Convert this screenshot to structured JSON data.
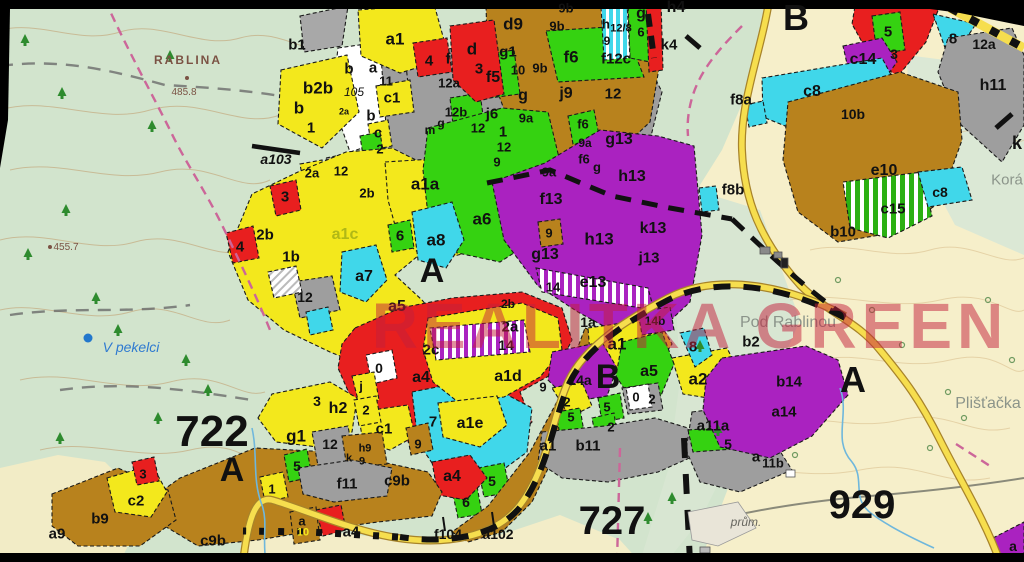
{
  "map": {
    "watermark": {
      "text": "REALITKA GREEN"
    },
    "region_numbers": [
      "722",
      "727",
      "929"
    ],
    "section_letters": [
      "A",
      "B"
    ],
    "place_names": [
      "RABLINA",
      "V pekelci",
      "Pod Rablinou",
      "Plišťačka",
      "Korá",
      "prům."
    ],
    "elevations": [
      "485.8",
      "455.7"
    ],
    "road_point_labels": [
      "a103",
      "f104",
      "a102"
    ],
    "palette": {
      "topo_green": "#d2e4cd",
      "cream": "#f6efca",
      "parcel_yellow": "#f3e81c",
      "parcel_green": "#35d211",
      "parcel_cyan": "#40d7ea",
      "parcel_purple": "#aa22c0",
      "parcel_red": "#e81f1f",
      "parcel_brown": "#b8821d",
      "parcel_gray": "#9e9e9e",
      "road_yellow": "#f6de4e",
      "watermark_red": "#c41f3c",
      "water_blue": "#2f7ad0"
    },
    "labels": [
      {
        "t": "b1",
        "x": 297,
        "y": 45
      },
      {
        "t": "b2b",
        "x": 318,
        "y": 88,
        "s": 17
      },
      {
        "t": "b",
        "x": 299,
        "y": 108,
        "s": 17
      },
      {
        "t": "1",
        "x": 311,
        "y": 128
      },
      {
        "t": "b",
        "x": 349,
        "y": 69
      },
      {
        "t": "105",
        "x": 354,
        "y": 92,
        "s": 12,
        "b": false,
        "it": true
      },
      {
        "t": "a",
        "x": 373,
        "y": 68
      },
      {
        "t": "11",
        "x": 386,
        "y": 81,
        "s": 13
      },
      {
        "t": "c1",
        "x": 392,
        "y": 98
      },
      {
        "t": "b",
        "x": 371,
        "y": 116
      },
      {
        "t": "c",
        "x": 378,
        "y": 133
      },
      {
        "t": "2",
        "x": 380,
        "y": 149,
        "s": 13
      },
      {
        "t": "2a",
        "x": 344,
        "y": 112,
        "s": 9
      },
      {
        "t": "a103",
        "x": 276,
        "y": 159,
        "s": 14,
        "it": true
      },
      {
        "t": "2a",
        "x": 312,
        "y": 173,
        "s": 13
      },
      {
        "t": "12",
        "x": 341,
        "y": 171,
        "s": 13
      },
      {
        "t": "a1",
        "x": 395,
        "y": 39,
        "s": 17
      },
      {
        "t": "4",
        "x": 429,
        "y": 61
      },
      {
        "t": "f",
        "x": 448,
        "y": 59
      },
      {
        "t": "d",
        "x": 472,
        "y": 49,
        "s": 17
      },
      {
        "t": "3",
        "x": 479,
        "y": 69
      },
      {
        "t": "12a",
        "x": 449,
        "y": 83,
        "s": 13
      },
      {
        "t": "d9",
        "x": 513,
        "y": 24,
        "s": 17
      },
      {
        "t": "9b",
        "x": 566,
        "y": 8,
        "s": 13
      },
      {
        "t": "9b",
        "x": 557,
        "y": 26,
        "s": 13
      },
      {
        "t": "9b",
        "x": 540,
        "y": 68,
        "s": 13
      },
      {
        "t": "g1",
        "x": 508,
        "y": 52
      },
      {
        "t": "10",
        "x": 518,
        "y": 70,
        "s": 13
      },
      {
        "t": "f5",
        "x": 493,
        "y": 78,
        "s": 16
      },
      {
        "t": "f6",
        "x": 571,
        "y": 57,
        "s": 17
      },
      {
        "t": "g",
        "x": 523,
        "y": 96,
        "s": 16
      },
      {
        "t": "j9",
        "x": 566,
        "y": 94,
        "s": 16
      },
      {
        "t": "j6",
        "x": 492,
        "y": 114,
        "s": 15
      },
      {
        "t": "12b",
        "x": 456,
        "y": 112,
        "s": 13
      },
      {
        "t": "9a",
        "x": 526,
        "y": 118,
        "s": 13
      },
      {
        "t": "12",
        "x": 478,
        "y": 128,
        "s": 13
      },
      {
        "t": "1",
        "x": 503,
        "y": 132
      },
      {
        "t": "12",
        "x": 504,
        "y": 147,
        "s": 13
      },
      {
        "t": "m",
        "x": 430,
        "y": 130,
        "s": 12
      },
      {
        "t": "g",
        "x": 441,
        "y": 123,
        "s": 12
      },
      {
        "t": "12",
        "x": 613,
        "y": 94,
        "s": 15
      },
      {
        "t": "f12c",
        "x": 616,
        "y": 59,
        "s": 15
      },
      {
        "t": "h",
        "x": 606,
        "y": 24,
        "s": 13
      },
      {
        "t": "12/8",
        "x": 621,
        "y": 29,
        "s": 11
      },
      {
        "t": "9",
        "x": 607,
        "y": 41,
        "s": 12
      },
      {
        "t": "g",
        "x": 641,
        "y": 14,
        "s": 16
      },
      {
        "t": "6",
        "x": 641,
        "y": 32,
        "s": 13
      },
      {
        "t": "h4",
        "x": 676,
        "y": 8,
        "s": 16
      },
      {
        "t": "k4",
        "x": 669,
        "y": 45,
        "s": 15
      },
      {
        "t": "9",
        "x": 497,
        "y": 162,
        "s": 13
      },
      {
        "t": "9a",
        "x": 549,
        "y": 172,
        "s": 13
      },
      {
        "t": "f6",
        "x": 583,
        "y": 124,
        "s": 13
      },
      {
        "t": "9a",
        "x": 585,
        "y": 143,
        "s": 12
      },
      {
        "t": "f6",
        "x": 584,
        "y": 159,
        "s": 13
      },
      {
        "t": "g",
        "x": 597,
        "y": 167,
        "s": 13
      },
      {
        "t": "g13",
        "x": 619,
        "y": 140,
        "s": 16
      },
      {
        "t": "h13",
        "x": 632,
        "y": 177,
        "s": 16
      },
      {
        "t": "f13",
        "x": 551,
        "y": 200,
        "s": 16
      },
      {
        "t": "9",
        "x": 549,
        "y": 233,
        "s": 13
      },
      {
        "t": "g13",
        "x": 545,
        "y": 255,
        "s": 16
      },
      {
        "t": "h13",
        "x": 599,
        "y": 239,
        "s": 17
      },
      {
        "t": "k13",
        "x": 653,
        "y": 229,
        "s": 16
      },
      {
        "t": "j13",
        "x": 649,
        "y": 258,
        "s": 15
      },
      {
        "t": "e13",
        "x": 593,
        "y": 283,
        "s": 16
      },
      {
        "t": "14",
        "x": 553,
        "y": 287,
        "s": 13
      },
      {
        "t": "1a",
        "x": 588,
        "y": 322,
        "s": 14
      },
      {
        "t": "a1a",
        "x": 425,
        "y": 184,
        "s": 17
      },
      {
        "t": "2b",
        "x": 367,
        "y": 193,
        "s": 13
      },
      {
        "t": "a6",
        "x": 482,
        "y": 219,
        "s": 17
      },
      {
        "t": "a8",
        "x": 436,
        "y": 240,
        "s": 17
      },
      {
        "t": "6",
        "x": 400,
        "y": 236
      },
      {
        "t": "a1c",
        "x": 345,
        "y": 235,
        "s": 16,
        "c": "#b0b816"
      },
      {
        "t": "2b",
        "x": 265,
        "y": 235
      },
      {
        "t": "1b",
        "x": 291,
        "y": 257
      },
      {
        "t": "4",
        "x": 240,
        "y": 247
      },
      {
        "t": "3",
        "x": 285,
        "y": 197
      },
      {
        "t": "12",
        "x": 305,
        "y": 297,
        "s": 14
      },
      {
        "t": "A",
        "x": 432,
        "y": 271,
        "s": 34
      },
      {
        "t": "a7",
        "x": 364,
        "y": 277,
        "s": 16
      },
      {
        "t": "a5",
        "x": 397,
        "y": 307,
        "s": 16
      },
      {
        "t": "2b",
        "x": 508,
        "y": 304,
        "s": 12
      },
      {
        "t": "2a",
        "x": 510,
        "y": 327,
        "s": 15
      },
      {
        "t": "2c",
        "x": 431,
        "y": 350,
        "s": 15
      },
      {
        "t": "14",
        "x": 506,
        "y": 345,
        "s": 14
      },
      {
        "t": "a4",
        "x": 421,
        "y": 378,
        "s": 16
      },
      {
        "t": "a1d",
        "x": 508,
        "y": 377,
        "s": 16
      },
      {
        "t": "0",
        "x": 379,
        "y": 368,
        "s": 14
      },
      {
        "t": "j",
        "x": 361,
        "y": 386,
        "s": 13
      },
      {
        "t": "2",
        "x": 366,
        "y": 410,
        "s": 13
      },
      {
        "t": "9",
        "x": 543,
        "y": 387,
        "s": 13
      },
      {
        "t": "a1",
        "x": 617,
        "y": 344,
        "s": 17
      },
      {
        "t": "B",
        "x": 608,
        "y": 377,
        "s": 34
      },
      {
        "t": "14a",
        "x": 580,
        "y": 380,
        "s": 14
      },
      {
        "t": "a5",
        "x": 649,
        "y": 372,
        "s": 16
      },
      {
        "t": "8",
        "x": 693,
        "y": 347,
        "s": 15
      },
      {
        "t": "a2",
        "x": 698,
        "y": 379,
        "s": 17
      },
      {
        "t": "b2",
        "x": 751,
        "y": 342,
        "s": 15
      },
      {
        "t": "14b",
        "x": 655,
        "y": 321,
        "s": 12
      },
      {
        "t": "0",
        "x": 636,
        "y": 397,
        "s": 13
      },
      {
        "t": "2",
        "x": 652,
        "y": 399,
        "s": 13
      },
      {
        "t": "2",
        "x": 567,
        "y": 402,
        "s": 13
      },
      {
        "t": "5",
        "x": 571,
        "y": 417,
        "s": 13
      },
      {
        "t": "5",
        "x": 607,
        "y": 407,
        "s": 13
      },
      {
        "t": "2",
        "x": 611,
        "y": 427,
        "s": 13
      },
      {
        "t": "a11a",
        "x": 713,
        "y": 426,
        "s": 15
      },
      {
        "t": "5",
        "x": 728,
        "y": 444,
        "s": 14
      },
      {
        "t": "a",
        "x": 756,
        "y": 457,
        "s": 15
      },
      {
        "t": "11b",
        "x": 773,
        "y": 463,
        "s": 13
      },
      {
        "t": "b14",
        "x": 789,
        "y": 382,
        "s": 15
      },
      {
        "t": "a14",
        "x": 784,
        "y": 412,
        "s": 15
      },
      {
        "t": "a1",
        "x": 548,
        "y": 446,
        "s": 15
      },
      {
        "t": "b11",
        "x": 588,
        "y": 446,
        "s": 15
      },
      {
        "t": "a1e",
        "x": 470,
        "y": 424,
        "s": 16
      },
      {
        "t": "7",
        "x": 433,
        "y": 422,
        "s": 15
      },
      {
        "t": "9",
        "x": 418,
        "y": 444,
        "s": 13
      },
      {
        "t": "a4",
        "x": 452,
        "y": 477,
        "s": 16
      },
      {
        "t": "5",
        "x": 492,
        "y": 481,
        "s": 14
      },
      {
        "t": "6",
        "x": 466,
        "y": 502,
        "s": 14
      },
      {
        "t": "c1",
        "x": 384,
        "y": 429,
        "s": 15
      },
      {
        "t": "h9",
        "x": 365,
        "y": 449,
        "s": 11
      },
      {
        "t": "k",
        "x": 349,
        "y": 459,
        "s": 11
      },
      {
        "t": "9",
        "x": 362,
        "y": 462,
        "s": 11
      },
      {
        "t": "c9b",
        "x": 397,
        "y": 481,
        "s": 15
      },
      {
        "t": "f11",
        "x": 347,
        "y": 484,
        "s": 15
      },
      {
        "t": "12",
        "x": 330,
        "y": 444,
        "s": 14
      },
      {
        "t": "g1",
        "x": 296,
        "y": 436,
        "s": 17
      },
      {
        "t": "h2",
        "x": 338,
        "y": 409,
        "s": 16
      },
      {
        "t": "3",
        "x": 317,
        "y": 401,
        "s": 14
      },
      {
        "t": "5",
        "x": 297,
        "y": 466,
        "s": 14
      },
      {
        "t": "1",
        "x": 272,
        "y": 489,
        "s": 13
      },
      {
        "t": "c9b",
        "x": 213,
        "y": 541,
        "s": 15
      },
      {
        "t": "b9",
        "x": 100,
        "y": 519,
        "s": 15
      },
      {
        "t": "a9",
        "x": 57,
        "y": 534,
        "s": 15
      },
      {
        "t": "c2",
        "x": 136,
        "y": 501,
        "s": 15
      },
      {
        "t": "3",
        "x": 143,
        "y": 474,
        "s": 13
      },
      {
        "t": "a",
        "x": 302,
        "y": 521,
        "s": 13
      },
      {
        "t": "10",
        "x": 303,
        "y": 533,
        "s": 11,
        "c": "#f3e81c"
      },
      {
        "t": "a4",
        "x": 351,
        "y": 532,
        "s": 15
      },
      {
        "t": "f104",
        "x": 448,
        "y": 534,
        "s": 14
      },
      {
        "t": "a102",
        "x": 498,
        "y": 534,
        "s": 14
      },
      {
        "t": "722",
        "x": 212,
        "y": 432,
        "s": 44
      },
      {
        "t": "A",
        "x": 232,
        "y": 470,
        "s": 34
      },
      {
        "t": "727",
        "x": 612,
        "y": 521,
        "s": 40
      },
      {
        "t": "929",
        "x": 862,
        "y": 505,
        "s": 40
      },
      {
        "t": "A",
        "x": 853,
        "y": 380,
        "s": 36
      },
      {
        "t": "B",
        "x": 796,
        "y": 18,
        "s": 36
      },
      {
        "t": "c14",
        "x": 863,
        "y": 60,
        "s": 16
      },
      {
        "t": "5",
        "x": 888,
        "y": 32,
        "s": 15
      },
      {
        "t": "3",
        "x": 894,
        "y": 54,
        "s": 14
      },
      {
        "t": "8",
        "x": 953,
        "y": 39,
        "s": 15
      },
      {
        "t": "12a",
        "x": 984,
        "y": 44,
        "s": 14
      },
      {
        "t": "h11",
        "x": 993,
        "y": 86,
        "s": 16
      },
      {
        "t": "k",
        "x": 1017,
        "y": 143,
        "s": 18
      },
      {
        "t": "c8",
        "x": 812,
        "y": 92,
        "s": 16
      },
      {
        "t": "10b",
        "x": 853,
        "y": 114,
        "s": 14
      },
      {
        "t": "e10",
        "x": 884,
        "y": 171,
        "s": 16
      },
      {
        "t": "c15",
        "x": 893,
        "y": 209,
        "s": 15
      },
      {
        "t": "c8",
        "x": 940,
        "y": 192,
        "s": 14
      },
      {
        "t": "b10",
        "x": 843,
        "y": 232,
        "s": 15
      },
      {
        "t": "f8a",
        "x": 741,
        "y": 100,
        "s": 15
      },
      {
        "t": "f8b",
        "x": 733,
        "y": 190,
        "s": 15
      },
      {
        "t": "a",
        "x": 1013,
        "y": 546,
        "s": 14
      },
      {
        "t": "RABLINA",
        "x": 188,
        "y": 60,
        "s": 12,
        "c": "#7b5244",
        "ls": 2
      },
      {
        "t": "485.8",
        "x": 184,
        "y": 93,
        "s": 10,
        "c": "#7b5244",
        "b": false
      },
      {
        "t": "455.7",
        "x": 66,
        "y": 248,
        "s": 10,
        "c": "#7b5244",
        "b": false
      },
      {
        "t": "V pekelci",
        "x": 131,
        "y": 347,
        "s": 14,
        "c": "#2f7ad0",
        "b": false,
        "it": true
      },
      {
        "t": "Pod Rablinou",
        "x": 788,
        "y": 323,
        "s": 16,
        "c": "#8b948a",
        "b": false
      },
      {
        "t": "Plišťačka",
        "x": 988,
        "y": 404,
        "s": 16,
        "c": "#8b948a",
        "b": false
      },
      {
        "t": "Korá",
        "x": 1007,
        "y": 180,
        "s": 15,
        "c": "#8b948a",
        "b": false
      },
      {
        "t": "prům.",
        "x": 746,
        "y": 522,
        "s": 12,
        "c": "#66655e",
        "b": false,
        "it": true
      }
    ]
  }
}
